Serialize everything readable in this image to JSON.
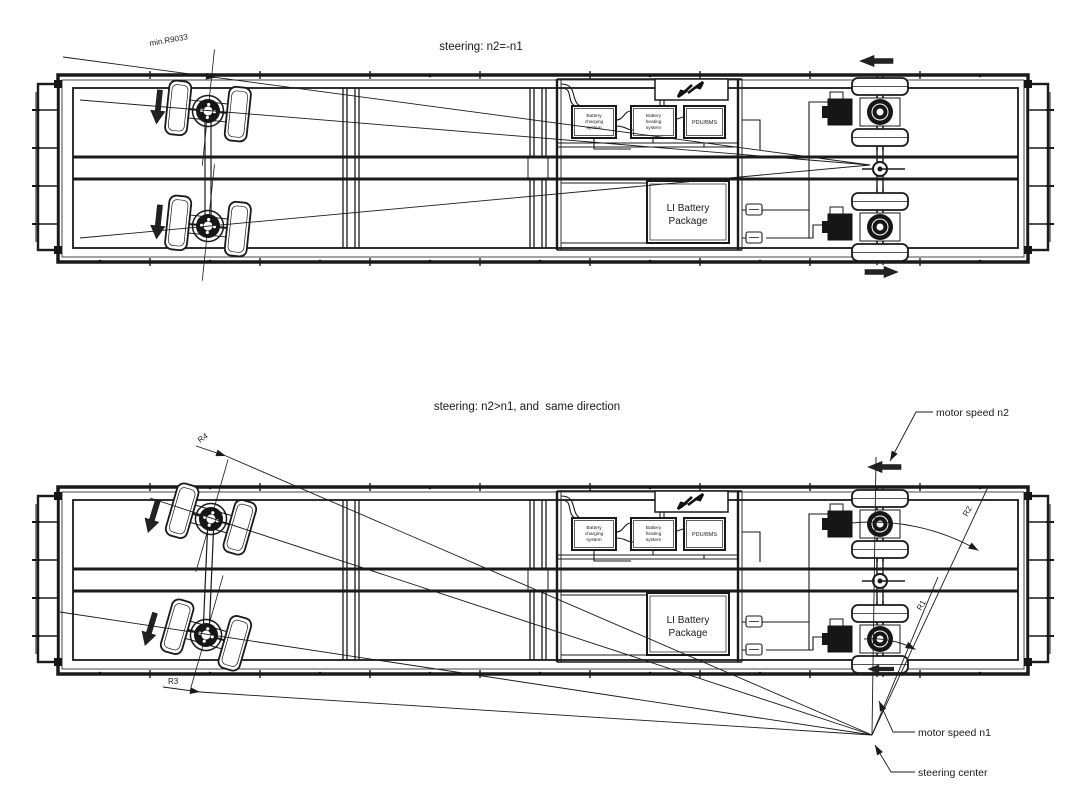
{
  "diagram": {
    "top": {
      "title": "steering: n2=-n1",
      "min_radius_label": "min.R9033"
    },
    "bottom": {
      "title": "steering: n2>n1, and  same direction",
      "r1": "R1",
      "r2": "R2",
      "r3": "R3",
      "r4": "R4",
      "motor_speed_n2": "motor speed n2",
      "motor_speed_n1": "motor speed n1",
      "steering_center": "steering center"
    }
  },
  "battery": {
    "charging_l1": "Battery",
    "charging_l2": "charging",
    "charging_l3": "system",
    "heating_l1": "Battery",
    "heating_l2": "heating",
    "heating_l3": "system",
    "pdu": "PDU/BMS",
    "li_l1": "LI Battery",
    "li_l2": "Package"
  },
  "colors": {
    "line": "#1a1a1a",
    "background": "#ffffff"
  }
}
